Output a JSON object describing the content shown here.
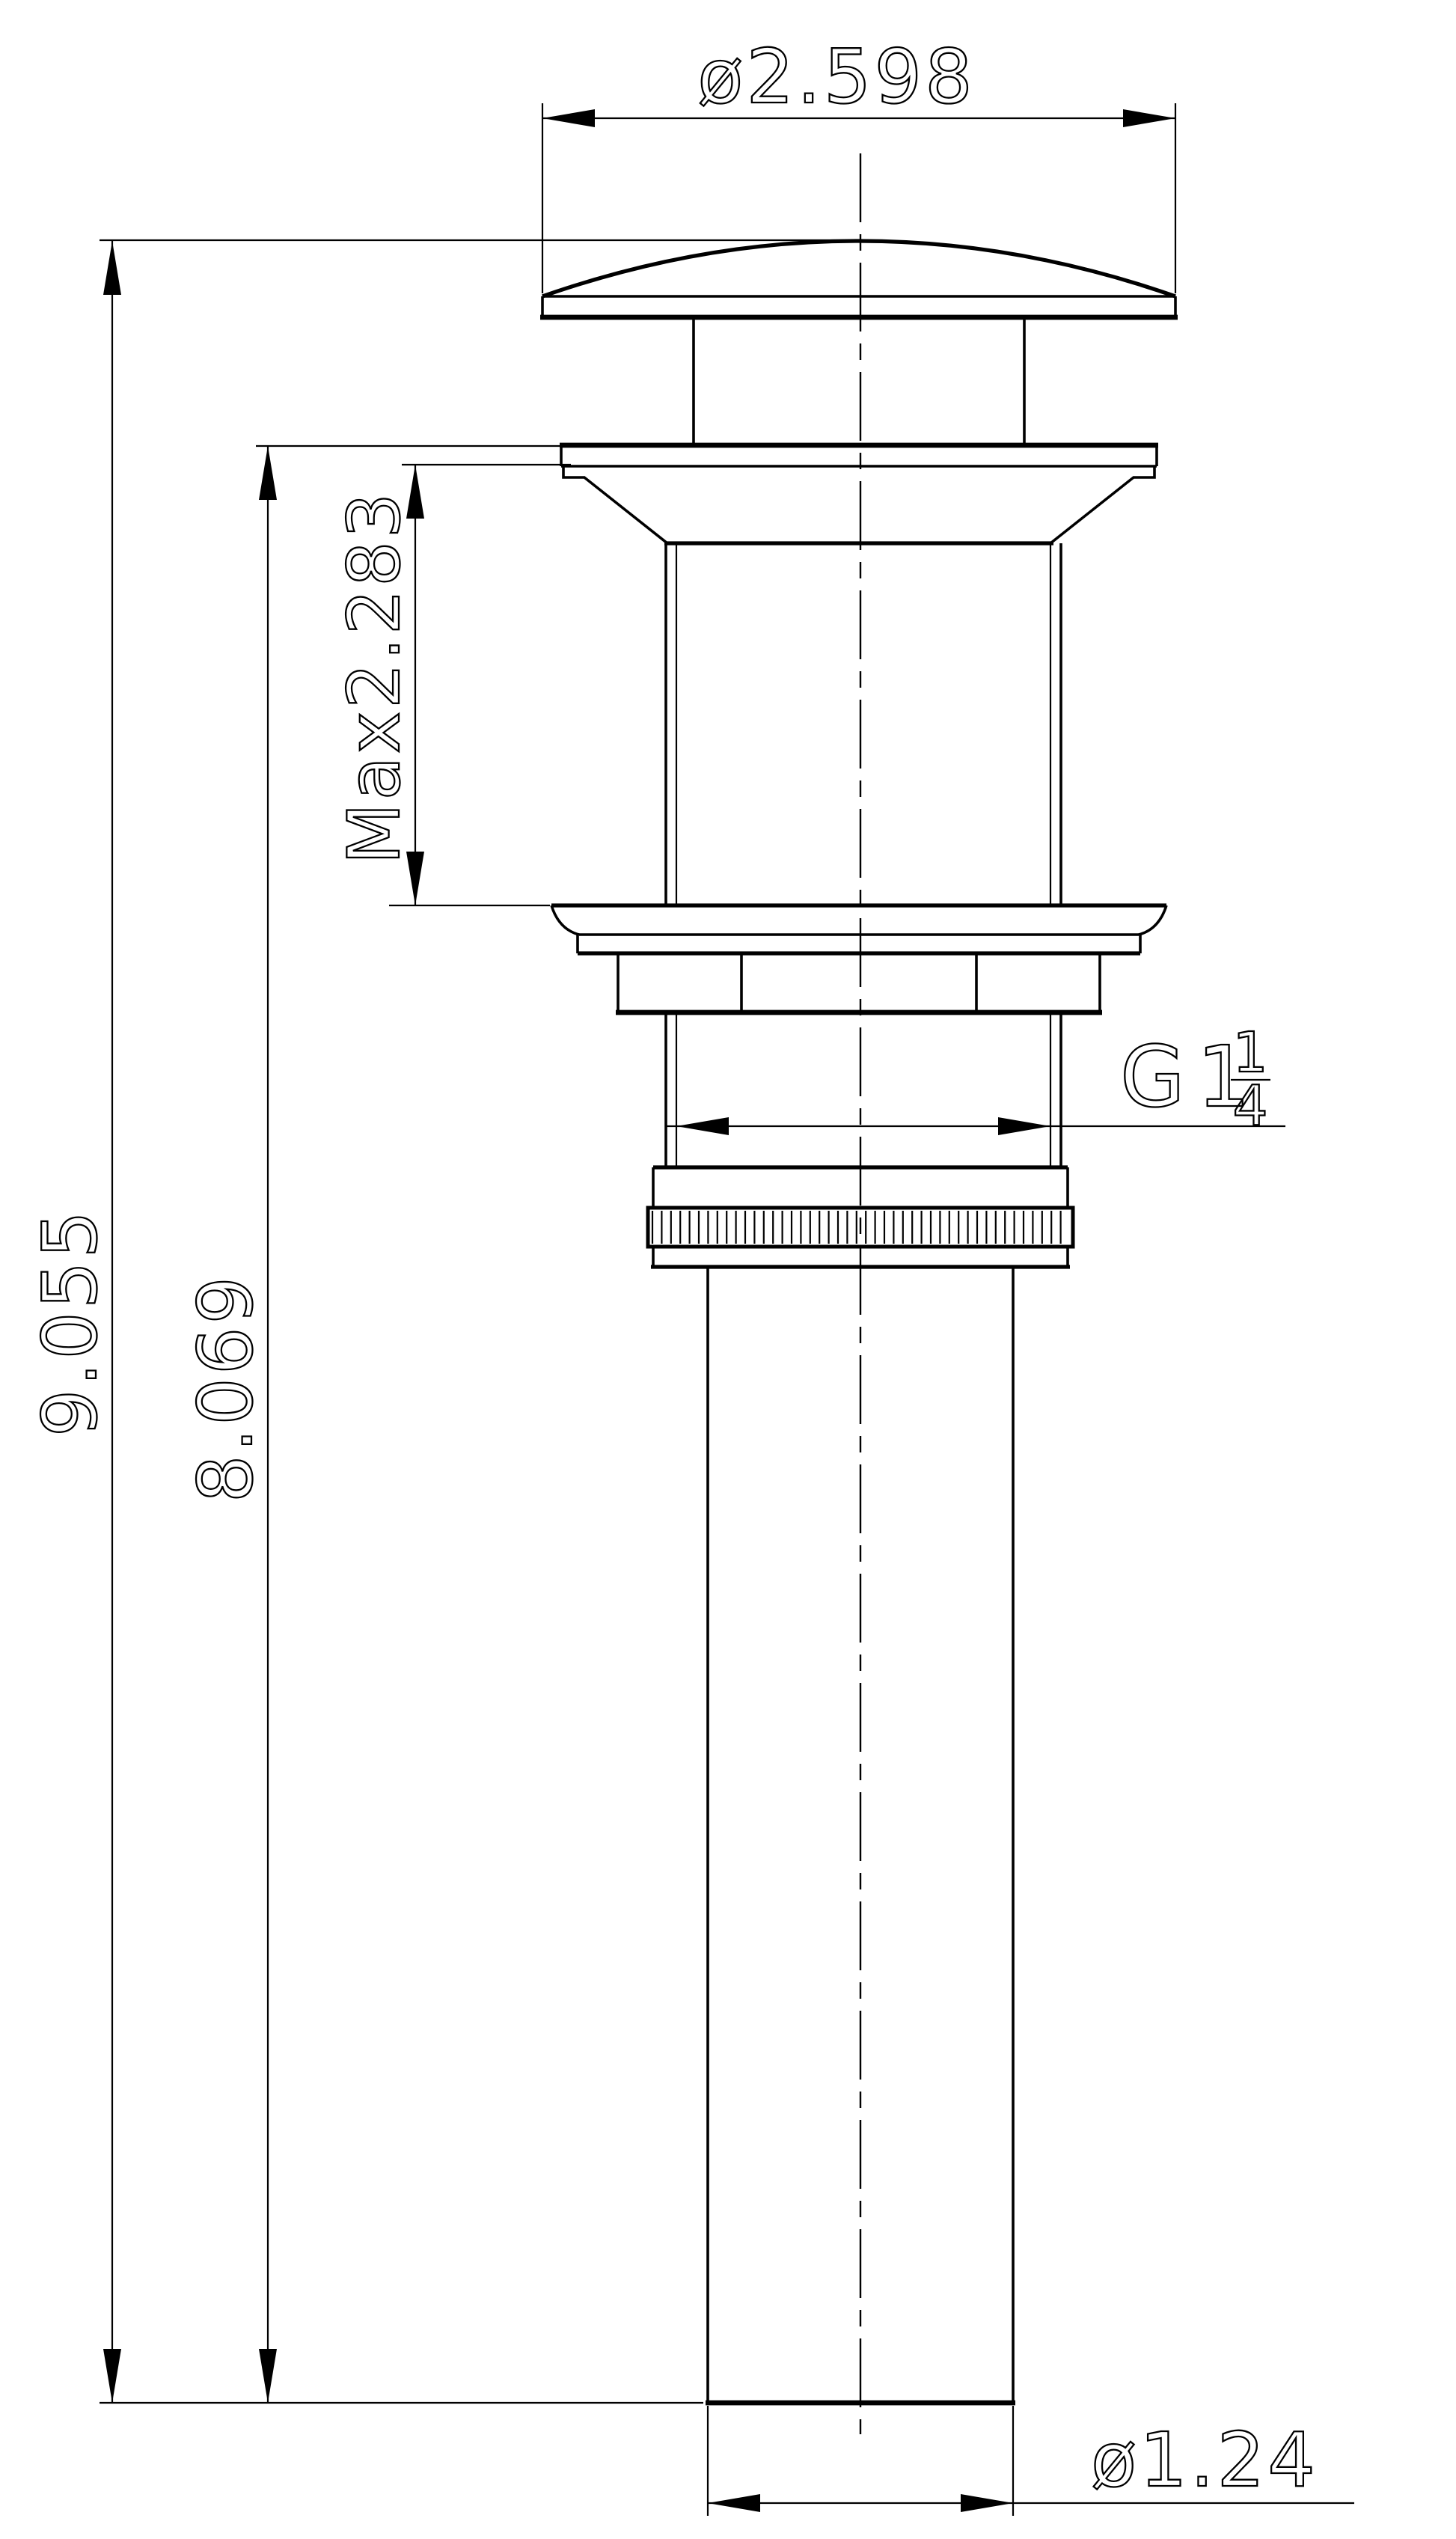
{
  "diagram": {
    "type": "technical-drawing-pop-up-drain",
    "background": "#ffffff",
    "stroke_color": "#000000",
    "labels": {
      "cap_diameter": "ø2.598",
      "overall_height": "9.055",
      "below_flange_height": "8.069",
      "max_mounting_thickness": "Max2.283",
      "thread_prefix": "G1",
      "thread_fraction_numerator": "1",
      "thread_fraction_denominator": "4",
      "tail_diameter": "ø1.24"
    }
  }
}
